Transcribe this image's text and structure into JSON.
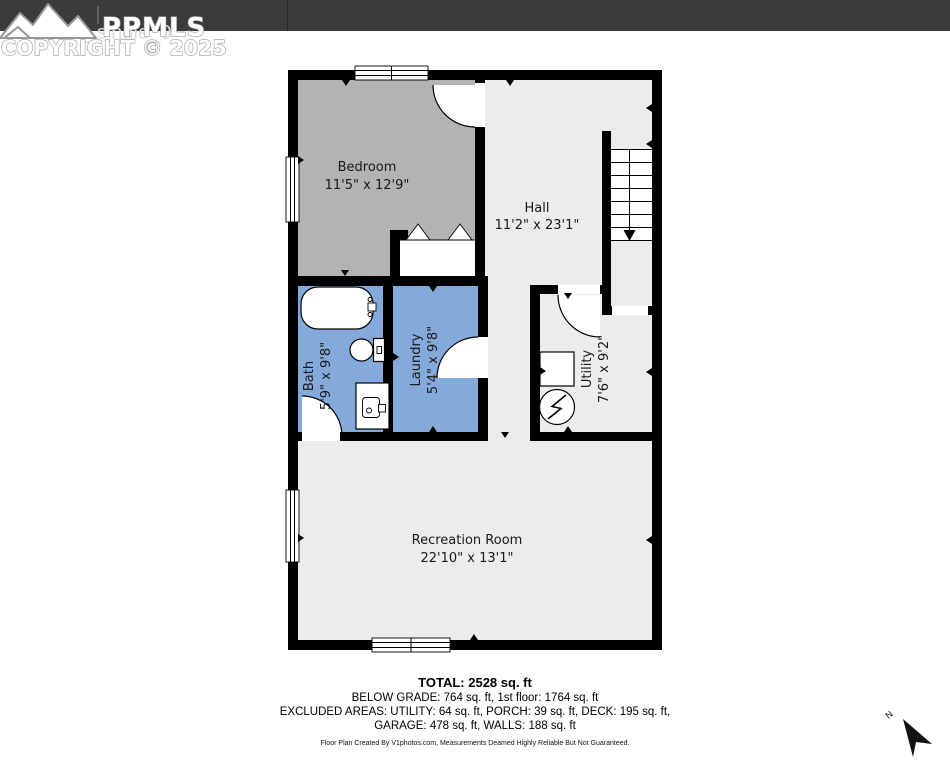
{
  "window_title": "floorplan_single_0",
  "watermark": {
    "brand": "PPMLS",
    "copyright": "COPYRIGHT © 2025"
  },
  "rooms": {
    "bedroom": {
      "name": "Bedroom",
      "dims": "11'5\" x 12'9\""
    },
    "hall": {
      "name": "Hall",
      "dims": "11'2\" x 23'1\""
    },
    "bath": {
      "name": "Bath",
      "dims": "5'9\" x 9'8\""
    },
    "laundry": {
      "name": "Laundry",
      "dims": "5'4\" x 9'8\""
    },
    "utility": {
      "name": "Utility",
      "dims": "7'6\" x 9'2\""
    },
    "recreation": {
      "name": "Recreation Room",
      "dims": "22'10\" x 13'1\""
    }
  },
  "compass": {
    "label": "N"
  },
  "summary": {
    "total": "TOTAL: 2528 sq. ft",
    "below_grade": "BELOW GRADE: 764 sq. ft, 1st floor: 1764 sq. ft",
    "excluded": "EXCLUDED AREAS: UTILITY: 64 sq. ft, PORCH: 39 sq. ft, DECK: 195 sq. ft,",
    "garage": "GARAGE: 478 sq. ft, WALLS: 188 sq. ft",
    "disclaimer": "Floor Plan Created By V1photos.com, Measurements Deamed Highly Reliable But Not Guaranteed."
  },
  "colors": {
    "wall": "#000000",
    "bedroom_fill": "#b3b3b3",
    "wet_room_fill": "#84aadb",
    "floor_fill": "#ececec",
    "header_bar": "#3b3b3b"
  }
}
